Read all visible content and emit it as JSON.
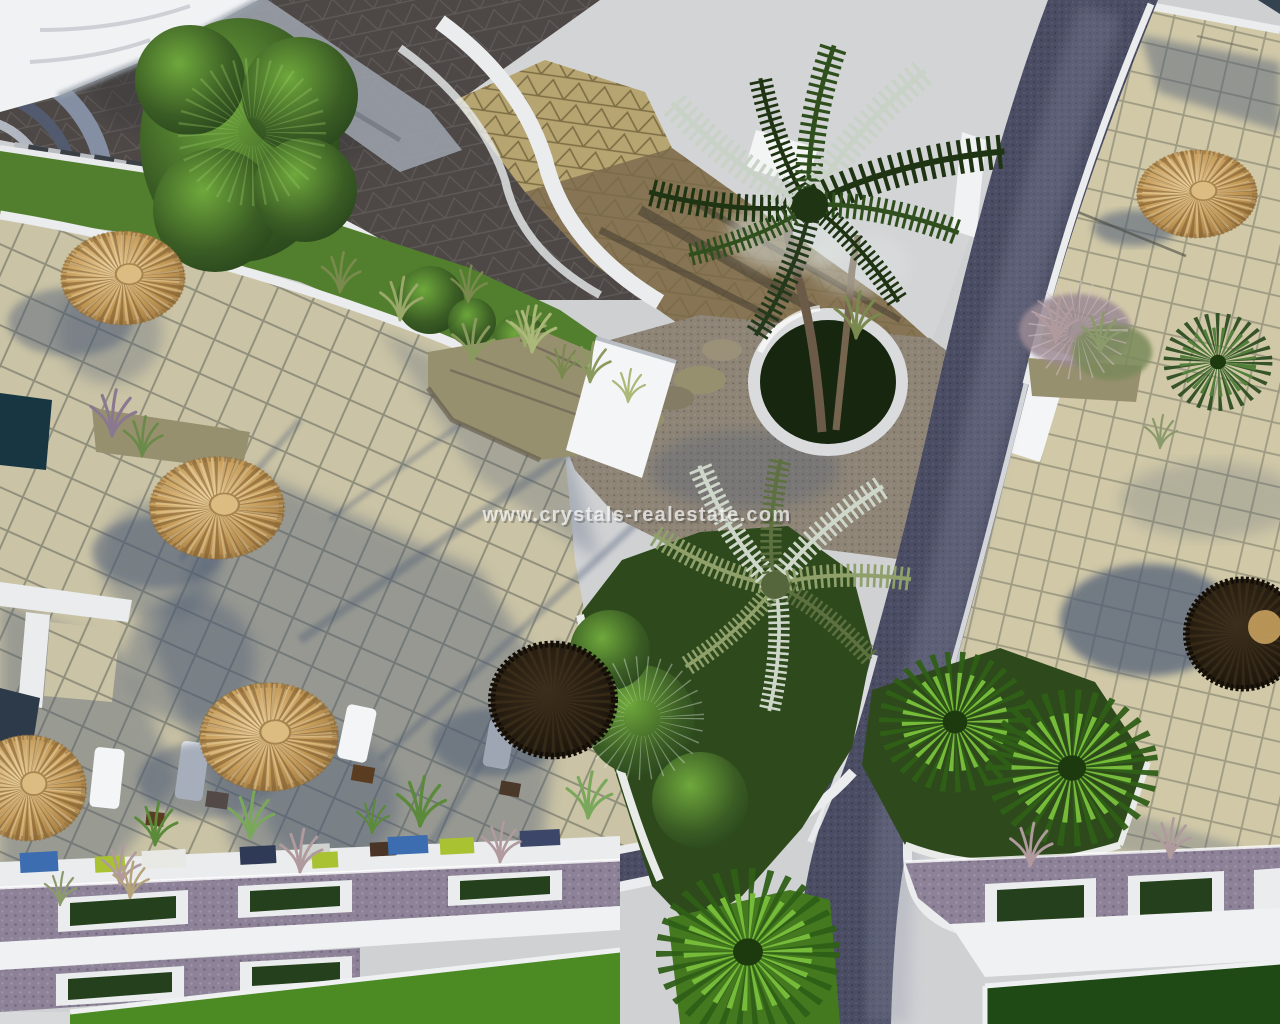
{
  "scene": {
    "type": "aerial-3d-architectural-render",
    "description": "Bird's-eye 3D rendering of a resort courtyard: tiled plazas with straw parasols and sun loungers, palm trees in round planters, landscaped green strips, curved white roof terraces and a winding dark cobble pedestrian path leading to a street with planter boxes and lawns.",
    "watermark": {
      "text": "www.crystals-realestate.com"
    },
    "colors": {
      "sky": "#ced0d2",
      "canopy": "#f1f2f4",
      "roof_dark": "#4d4846",
      "roof_tan": "#b6a571",
      "roof_tan_shade": "#867454",
      "grass": "#527f2e",
      "tile": "#cac3a5",
      "terrace_tile": "#d0c8a7",
      "paving": "#8e8577",
      "stone": "#97906f",
      "path": "#4a4d63",
      "curb": "#eaeced",
      "wall": "#8d8298",
      "white_band": "#f0f1f2",
      "garden": "#2e4a1c",
      "lawn": "#44791f",
      "lawn_bright": "#4c8a24",
      "lawn_dark": "#1f4a16",
      "pool": "#173642",
      "planter_green": "#24401c",
      "shadow": "#4c5a74",
      "straw": "#c49a58",
      "umbrella_dark": "#1c150c",
      "palm_bright": "#76bb3a",
      "watermark": "#f8f8f8"
    },
    "elements": {
      "straw_parasols": 5,
      "dark_parasols": 2,
      "palm_trees": 6,
      "sun_loungers": 4,
      "planter_boxes": 7,
      "labels": [
        "straw parasol",
        "palm tree",
        "tiled plaza",
        "pedestrian path",
        "white curb",
        "planter box",
        "lawn",
        "sun lounger",
        "roof canopy",
        "garden strip"
      ]
    }
  }
}
